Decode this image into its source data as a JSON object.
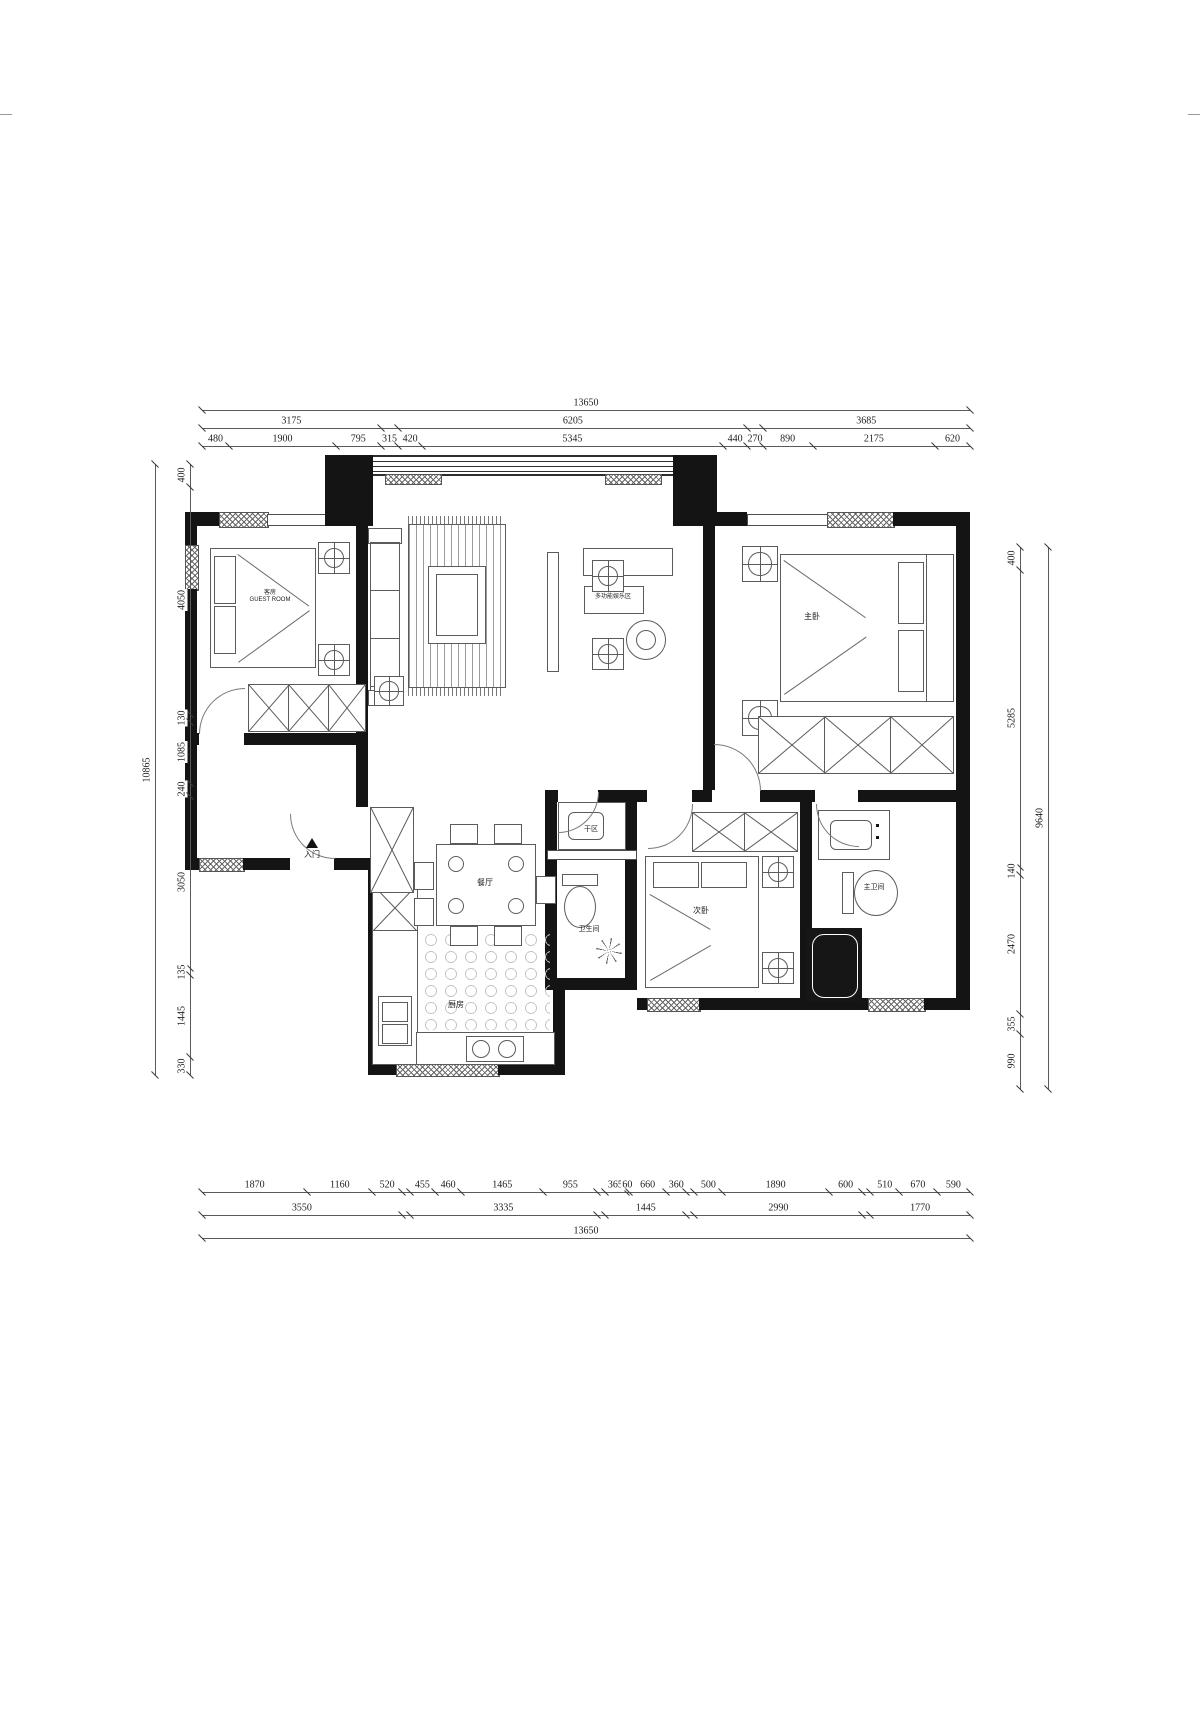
{
  "rooms": {
    "guest": {
      "name": "客房",
      "subtitle": "GUEST ROOM"
    },
    "living": {
      "name": "多功能娱乐区"
    },
    "master": {
      "name": "主卧"
    },
    "dining": {
      "name": "餐厅"
    },
    "dry_area": {
      "name": "干区"
    },
    "bathroom": {
      "name": "卫生间"
    },
    "second_bedroom": {
      "name": "次卧"
    },
    "master_bathroom": {
      "name": "主卫间"
    },
    "kitchen": {
      "name": "厨房"
    },
    "entry": {
      "name": "入门"
    }
  },
  "colors": {
    "wall": "#141414",
    "line": "#5b5b5b",
    "dim_text": "#1c1c1c",
    "background": "#ffffff"
  },
  "dimensions": {
    "rows": [
      {
        "id": "top-overall",
        "side": "top",
        "track": 0,
        "segments": [
          {
            "mm": 13650,
            "label": "13650"
          }
        ]
      },
      {
        "id": "top-groups",
        "side": "top",
        "track": 1,
        "segments": [
          {
            "mm": 3175,
            "label": "3175"
          },
          {
            "mm": 315,
            "label": ""
          },
          {
            "mm": 6205,
            "label": "6205"
          },
          {
            "mm": 270,
            "label": ""
          },
          {
            "mm": 3685,
            "label": "3685"
          }
        ]
      },
      {
        "id": "top-detail",
        "side": "top",
        "track": 2,
        "segments": [
          {
            "mm": 480,
            "label": "480"
          },
          {
            "mm": 1900,
            "label": "1900"
          },
          {
            "mm": 795,
            "label": "795"
          },
          {
            "mm": 315,
            "label": "315"
          },
          {
            "mm": 420,
            "label": "420"
          },
          {
            "mm": 5345,
            "label": "5345"
          },
          {
            "mm": 440,
            "label": "440"
          },
          {
            "mm": 270,
            "label": "270"
          },
          {
            "mm": 890,
            "label": "890"
          },
          {
            "mm": 2175,
            "label": "2175"
          },
          {
            "mm": 620,
            "label": "620"
          }
        ]
      },
      {
        "id": "bottom-detail",
        "side": "bottom",
        "track": 0,
        "segments": [
          {
            "mm": 1870,
            "label": "1870"
          },
          {
            "mm": 1160,
            "label": "1160"
          },
          {
            "mm": 520,
            "label": "520"
          },
          {
            "mm": 140,
            "label": ""
          },
          {
            "mm": 455,
            "label": "455"
          },
          {
            "mm": 460,
            "label": "460"
          },
          {
            "mm": 1465,
            "label": "1465"
          },
          {
            "mm": 955,
            "label": "955"
          },
          {
            "mm": 140,
            "label": ""
          },
          {
            "mm": 365,
            "label": "365"
          },
          {
            "mm": 60,
            "label": "60"
          },
          {
            "mm": 660,
            "label": "660"
          },
          {
            "mm": 360,
            "label": "360"
          },
          {
            "mm": 140,
            "label": ""
          },
          {
            "mm": 500,
            "label": "500"
          },
          {
            "mm": 1890,
            "label": "1890"
          },
          {
            "mm": 600,
            "label": "600"
          },
          {
            "mm": 140,
            "label": ""
          },
          {
            "mm": 510,
            "label": "510"
          },
          {
            "mm": 670,
            "label": "670"
          },
          {
            "mm": 590,
            "label": "590"
          }
        ]
      },
      {
        "id": "bottom-groups",
        "side": "bottom",
        "track": 1,
        "segments": [
          {
            "mm": 3550,
            "label": "3550"
          },
          {
            "mm": 140,
            "label": ""
          },
          {
            "mm": 3335,
            "label": "3335"
          },
          {
            "mm": 140,
            "label": ""
          },
          {
            "mm": 1445,
            "label": "1445"
          },
          {
            "mm": 140,
            "label": ""
          },
          {
            "mm": 2990,
            "label": "2990"
          },
          {
            "mm": 140,
            "label": ""
          },
          {
            "mm": 1770,
            "label": "1770"
          }
        ]
      },
      {
        "id": "bottom-overall",
        "side": "bottom",
        "track": 2,
        "segments": [
          {
            "mm": 13650,
            "label": "13650"
          }
        ]
      },
      {
        "id": "left-detail",
        "side": "left",
        "track": 0,
        "segments": [
          {
            "mm": 400,
            "label": "400"
          },
          {
            "mm": 4050,
            "label": "4050"
          },
          {
            "mm": 130,
            "label": "130"
          },
          {
            "mm": 1085,
            "label": "1085"
          },
          {
            "mm": 240,
            "label": "240"
          },
          {
            "mm": 3050,
            "label": "3050"
          },
          {
            "mm": 135,
            "label": "135"
          },
          {
            "mm": 1445,
            "label": "1445"
          },
          {
            "mm": 330,
            "label": "330"
          }
        ]
      },
      {
        "id": "left-overall",
        "side": "left",
        "track": 1,
        "segments": [
          {
            "mm": 10865,
            "label": "10865"
          }
        ]
      },
      {
        "id": "right-detail",
        "side": "right",
        "track": 0,
        "segments": [
          {
            "mm": 400,
            "label": "400"
          },
          {
            "mm": 5285,
            "label": "5285"
          },
          {
            "mm": 140,
            "label": "140"
          },
          {
            "mm": 2470,
            "label": "2470"
          },
          {
            "mm": 355,
            "label": "355"
          },
          {
            "mm": 990,
            "label": "990"
          }
        ]
      },
      {
        "id": "right-overall",
        "side": "right",
        "track": 1,
        "segments": [
          {
            "mm": 9640,
            "label": "9640"
          }
        ]
      }
    ]
  }
}
